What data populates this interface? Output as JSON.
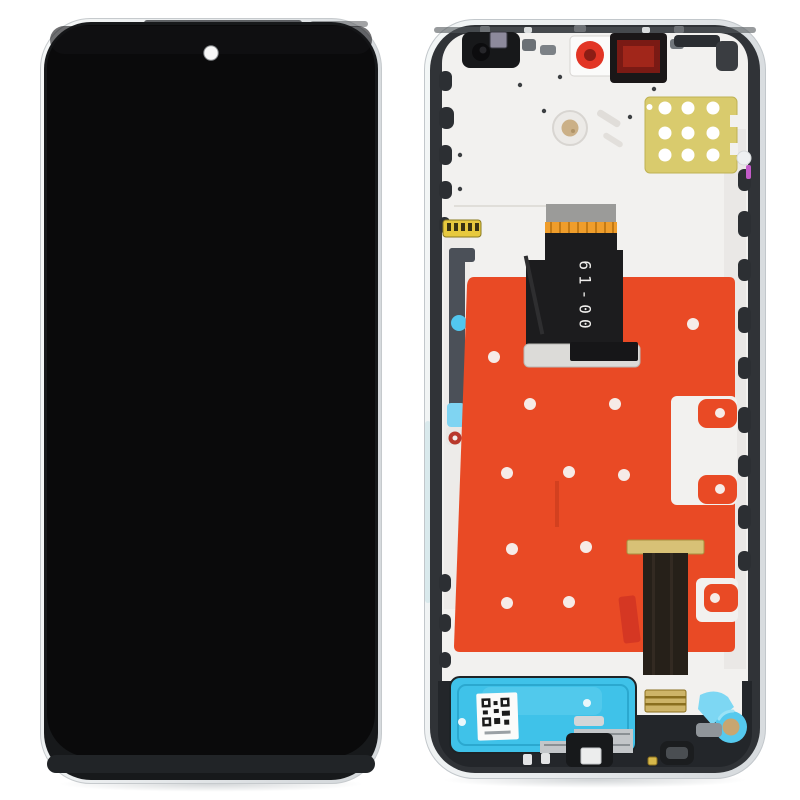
{
  "scene": {
    "description": "Product photo: phone LCD screen and digitizer full assembly with frame, front view on the left, back view on the right",
    "background": "#ffffff"
  },
  "front_panel": {
    "screen_color": "#0a0a0b",
    "chin_color": "#212427",
    "camera_dot_color": "#f7f7f7"
  },
  "back_panel": {
    "flex_cable_label": "61-00",
    "colors": {
      "rim_silver": "#e9edee",
      "inner_frame": "#303337",
      "back_plate": "#f2f1ef",
      "adhesive_sticker": "#e94a25",
      "sticker_hole": "#f6ebe7",
      "yellow_pad": "#d9cb6d",
      "pad_dot": "#ffffff",
      "speaker_adhesive": "#3fc2e9",
      "flex_black": "#1c1c1e",
      "flex2_body": "#262019",
      "flex_contact_gold": "#d8c176",
      "connector_gold": "#cdb468",
      "stiffener_gray": "#9b9b99",
      "orange_contact_band": "#ef9d2b",
      "camera_film_red": "#e23525",
      "camera_film_core": "#8c1d15",
      "camera_bracket_red": "#7a1a14",
      "camera_bracket_inner": "#a1261a",
      "antenna_gold": "#e7c93e",
      "cyan_dot": "#52c7ef",
      "cyan_patch": "#7fd4f2",
      "red_pull_tab": "#d53723",
      "screw_dot_red": "#b8382c",
      "motor_ring_cyan": "#55c9ee",
      "motor_center_tan": "#c8a671",
      "magenta_bit": "#c35bc9"
    },
    "sticker_holes": [
      [
        70,
        338
      ],
      [
        106,
        385
      ],
      [
        191,
        385
      ],
      [
        269,
        305
      ],
      [
        83,
        454
      ],
      [
        145,
        453
      ],
      [
        200,
        456
      ],
      [
        88,
        530
      ],
      [
        162,
        528
      ],
      [
        83,
        584
      ],
      [
        145,
        583
      ]
    ],
    "yellow_pad_dots": [
      [
        241,
        89
      ],
      [
        264,
        89
      ],
      [
        289,
        89
      ],
      [
        241,
        114
      ],
      [
        264,
        114
      ],
      [
        289,
        114
      ],
      [
        241,
        136
      ],
      [
        264,
        136
      ],
      [
        289,
        136
      ]
    ]
  }
}
